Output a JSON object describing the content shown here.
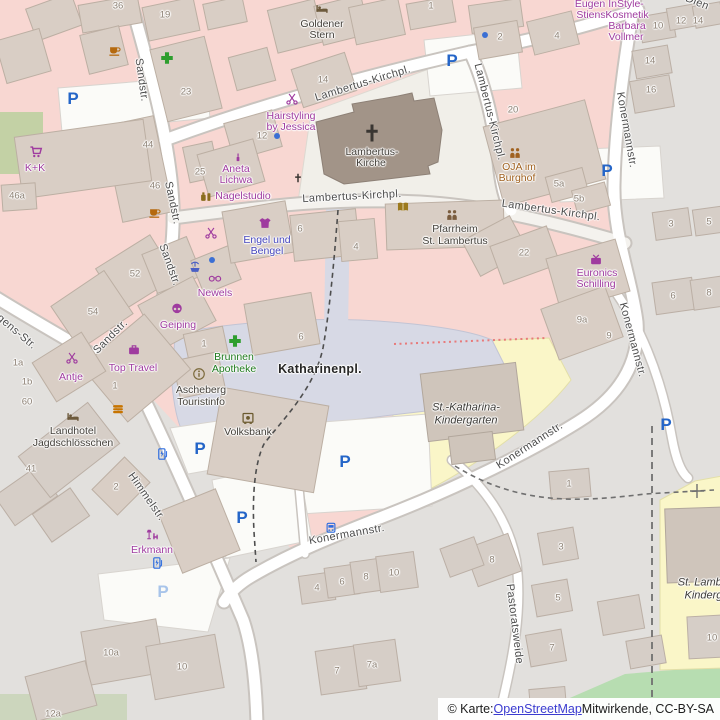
{
  "attribution": {
    "prefix": "© Karte: ",
    "link_text": "OpenStreetMap",
    "suffix": " Mitwirkende, CC-BY-SA"
  },
  "street_labels": [
    {
      "text": "Sandstr.",
      "x": 141,
      "y": 80,
      "rot": 82
    },
    {
      "text": "Sandstr.",
      "x": 172,
      "y": 203,
      "rot": 78
    },
    {
      "text": "Sandstr.",
      "x": 169,
      "y": 265,
      "rot": 70
    },
    {
      "text": "Sandstr.",
      "x": 111,
      "y": 337,
      "rot": -45
    },
    {
      "text": "Jürgens-Str.",
      "x": 10,
      "y": 327,
      "rot": 40
    },
    {
      "text": "Himmelstr.",
      "x": 146,
      "y": 497,
      "rot": 55
    },
    {
      "text": "Lambertus-Kirchpl.",
      "x": 363,
      "y": 84,
      "rot": -17
    },
    {
      "text": "Lambertus-Kirchpl.",
      "x": 489,
      "y": 112,
      "rot": 76
    },
    {
      "text": "Lambertus-Kirchpl.",
      "x": 352,
      "y": 197,
      "rot": -3
    },
    {
      "text": "Lambertus-Kirchpl.",
      "x": 551,
      "y": 211,
      "rot": 8
    },
    {
      "text": "Konermannstr.",
      "x": 626,
      "y": 130,
      "rot": 80
    },
    {
      "text": "Konermannstr.",
      "x": 632,
      "y": 340,
      "rot": 75
    },
    {
      "text": "Konermannstr.",
      "x": 530,
      "y": 446,
      "rot": -33
    },
    {
      "text": "Konermannstr.",
      "x": 347,
      "y": 535,
      "rot": -10
    },
    {
      "text": "Pastoratsweide",
      "x": 514,
      "y": 624,
      "rot": 83
    },
    {
      "text": "Dien",
      "x": 697,
      "y": 3,
      "rot": 22
    }
  ],
  "house_numbers": [
    {
      "text": "36",
      "x": 118,
      "y": 6
    },
    {
      "text": "19",
      "x": 165,
      "y": 15
    },
    {
      "text": "23",
      "x": 186,
      "y": 92
    },
    {
      "text": "25",
      "x": 200,
      "y": 172
    },
    {
      "text": "44",
      "x": 148,
      "y": 145
    },
    {
      "text": "46",
      "x": 155,
      "y": 186
    },
    {
      "text": "46a",
      "x": 17,
      "y": 196
    },
    {
      "text": "52",
      "x": 135,
      "y": 274
    },
    {
      "text": "54",
      "x": 93,
      "y": 312
    },
    {
      "text": "14",
      "x": 323,
      "y": 80
    },
    {
      "text": "12",
      "x": 262,
      "y": 136
    },
    {
      "text": "1",
      "x": 431,
      "y": 6
    },
    {
      "text": "2",
      "x": 500,
      "y": 37
    },
    {
      "text": "4",
      "x": 557,
      "y": 36
    },
    {
      "text": "20",
      "x": 513,
      "y": 110
    },
    {
      "text": "5a",
      "x": 559,
      "y": 184
    },
    {
      "text": "5b",
      "x": 579,
      "y": 199
    },
    {
      "text": "10",
      "x": 658,
      "y": 26
    },
    {
      "text": "12",
      "x": 681,
      "y": 21
    },
    {
      "text": "14",
      "x": 698,
      "y": 21
    },
    {
      "text": "14",
      "x": 650,
      "y": 61
    },
    {
      "text": "16",
      "x": 651,
      "y": 90
    },
    {
      "text": "3",
      "x": 671,
      "y": 224
    },
    {
      "text": "5",
      "x": 709,
      "y": 222
    },
    {
      "text": "22",
      "x": 524,
      "y": 253
    },
    {
      "text": "9a",
      "x": 582,
      "y": 320
    },
    {
      "text": "9",
      "x": 609,
      "y": 336
    },
    {
      "text": "6",
      "x": 673,
      "y": 296
    },
    {
      "text": "8",
      "x": 709,
      "y": 293
    },
    {
      "text": "6",
      "x": 300,
      "y": 229
    },
    {
      "text": "4",
      "x": 356,
      "y": 247
    },
    {
      "text": "6",
      "x": 301,
      "y": 337
    },
    {
      "text": "1",
      "x": 204,
      "y": 344
    },
    {
      "text": "1",
      "x": 115,
      "y": 386
    },
    {
      "text": "1a",
      "x": 18,
      "y": 363
    },
    {
      "text": "1b",
      "x": 27,
      "y": 382
    },
    {
      "text": "60",
      "x": 27,
      "y": 402
    },
    {
      "text": "41",
      "x": 31,
      "y": 469
    },
    {
      "text": "2",
      "x": 116,
      "y": 487
    },
    {
      "text": "4",
      "x": 317,
      "y": 588
    },
    {
      "text": "6",
      "x": 342,
      "y": 582
    },
    {
      "text": "8",
      "x": 366,
      "y": 577
    },
    {
      "text": "10",
      "x": 394,
      "y": 573
    },
    {
      "text": "7",
      "x": 337,
      "y": 671
    },
    {
      "text": "7a",
      "x": 372,
      "y": 665
    },
    {
      "text": "10",
      "x": 712,
      "y": 638
    },
    {
      "text": "1",
      "x": 569,
      "y": 484
    },
    {
      "text": "3",
      "x": 561,
      "y": 547
    },
    {
      "text": "5",
      "x": 558,
      "y": 598
    },
    {
      "text": "7",
      "x": 552,
      "y": 648
    },
    {
      "text": "8",
      "x": 492,
      "y": 560
    },
    {
      "text": "10a",
      "x": 111,
      "y": 653
    },
    {
      "text": "10",
      "x": 182,
      "y": 667
    },
    {
      "text": "12a",
      "x": 53,
      "y": 714
    }
  ],
  "poi_labels": [
    {
      "text": "Goldener",
      "x": 322,
      "y": 24,
      "cls": "drk"
    },
    {
      "text": "Stern",
      "x": 322,
      "y": 35,
      "cls": "drk"
    },
    {
      "text": "Hairstyling",
      "x": 291,
      "y": 116,
      "cls": "shop"
    },
    {
      "text": "by Jessica",
      "x": 291,
      "y": 127,
      "cls": "shop"
    },
    {
      "text": "Aneta",
      "x": 236,
      "y": 169,
      "cls": "shop"
    },
    {
      "text": "Lichwa",
      "x": 236,
      "y": 180,
      "cls": "shop"
    },
    {
      "text": "Nagelstudio",
      "x": 243,
      "y": 196,
      "cls": "shop"
    },
    {
      "text": "K+K",
      "x": 35,
      "y": 168,
      "cls": "shop"
    },
    {
      "text": "Engel und",
      "x": 267,
      "y": 240,
      "cls": "blu"
    },
    {
      "text": "Bengel",
      "x": 267,
      "y": 251,
      "cls": "blu"
    },
    {
      "text": "Newels",
      "x": 215,
      "y": 293,
      "cls": "shop"
    },
    {
      "text": "Geiping",
      "x": 178,
      "y": 325,
      "cls": "shop"
    },
    {
      "text": "Top Travel",
      "x": 133,
      "y": 368,
      "cls": "shop"
    },
    {
      "text": "Antje",
      "x": 71,
      "y": 377,
      "cls": "shop"
    },
    {
      "text": "Brunnen",
      "x": 234,
      "y": 357,
      "cls": "grn"
    },
    {
      "text": "Apotheke",
      "x": 234,
      "y": 369,
      "cls": "grn"
    },
    {
      "text": "Ascheberg",
      "x": 201,
      "y": 390,
      "cls": "drk"
    },
    {
      "text": "Touristinfo",
      "x": 201,
      "y": 402,
      "cls": "drk"
    },
    {
      "text": "Volksbank",
      "x": 248,
      "y": 432,
      "cls": "drk"
    },
    {
      "text": "Landhotel",
      "x": 73,
      "y": 431,
      "cls": "drk"
    },
    {
      "text": "Jagdschlösschen",
      "x": 73,
      "y": 443,
      "cls": "drk"
    },
    {
      "text": "Erkmann",
      "x": 152,
      "y": 550,
      "cls": "shop"
    },
    {
      "text": "Pfarrheim",
      "x": 455,
      "y": 229,
      "cls": "drk"
    },
    {
      "text": "St. Lambertus",
      "x": 455,
      "y": 241,
      "cls": "drk"
    },
    {
      "text": "OJA im",
      "x": 519,
      "y": 167,
      "cls": "amb"
    },
    {
      "text": "Burghof",
      "x": 517,
      "y": 178,
      "cls": "amb"
    },
    {
      "text": "Eugen",
      "x": 590,
      "y": 4,
      "cls": "shop"
    },
    {
      "text": "Stiens",
      "x": 591,
      "y": 15,
      "cls": "shop"
    },
    {
      "text": "InStyle-",
      "x": 626,
      "y": 4,
      "cls": "shop"
    },
    {
      "text": "Kosmetik",
      "x": 627,
      "y": 15,
      "cls": "shop"
    },
    {
      "text": "Barbara",
      "x": 627,
      "y": 26,
      "cls": "shop"
    },
    {
      "text": "Vollmer",
      "x": 626,
      "y": 37,
      "cls": "shop"
    },
    {
      "text": "Euronics",
      "x": 597,
      "y": 273,
      "cls": "shop"
    },
    {
      "text": "Schilling",
      "x": 596,
      "y": 284,
      "cls": "shop"
    },
    {
      "text": "Lambertus-",
      "x": 372,
      "y": 152,
      "cls": "drk"
    },
    {
      "text": "Kirche",
      "x": 371,
      "y": 163,
      "cls": "drk"
    },
    {
      "text": "St.-Katharina-",
      "x": 466,
      "y": 408,
      "cls": "ital"
    },
    {
      "text": "Kindergarten",
      "x": 466,
      "y": 421,
      "cls": "ital"
    },
    {
      "text": "St. Lambertus",
      "x": 712,
      "y": 583,
      "cls": "ital"
    },
    {
      "text": "Kindergarten",
      "x": 716,
      "y": 596,
      "cls": "ital"
    },
    {
      "text": "Katharinenpl.",
      "x": 320,
      "y": 369,
      "cls": "place"
    }
  ],
  "icons": [
    {
      "icon": "supermarket",
      "x": 36,
      "y": 152,
      "color": "#9f3b9f"
    },
    {
      "icon": "cafe",
      "x": 115,
      "y": 50,
      "color": "#b5690e"
    },
    {
      "icon": "cafe",
      "x": 155,
      "y": 212,
      "color": "#b5690e"
    },
    {
      "icon": "pharmacy",
      "x": 167,
      "y": 58,
      "color": "#2e9e2e",
      "size": 15
    },
    {
      "icon": "pharmacy",
      "x": 235,
      "y": 341,
      "color": "#2e9e2e",
      "size": 15
    },
    {
      "icon": "hairdresser",
      "x": 292,
      "y": 99,
      "color": "#9f3b9f"
    },
    {
      "icon": "hairdresser",
      "x": 72,
      "y": 358,
      "color": "#9f3b9f"
    },
    {
      "icon": "hairdresser",
      "x": 211,
      "y": 233,
      "color": "#9f3b9f"
    },
    {
      "icon": "beauty",
      "x": 238,
      "y": 157,
      "color": "#9f3b9f",
      "size": 11
    },
    {
      "icon": "cosmetics",
      "x": 206,
      "y": 196,
      "color": "#8a6d1e"
    },
    {
      "icon": "clothes",
      "x": 265,
      "y": 223,
      "color": "#9f3b9f"
    },
    {
      "icon": "optician",
      "x": 215,
      "y": 278,
      "color": "#9f3b9f"
    },
    {
      "icon": "fountain",
      "x": 195,
      "y": 267,
      "color": "#4a5fc4"
    },
    {
      "icon": "bakery",
      "x": 177,
      "y": 308,
      "color": "#9f3b9f"
    },
    {
      "icon": "travel",
      "x": 134,
      "y": 350,
      "color": "#9f3b9f"
    },
    {
      "icon": "fastfood",
      "x": 118,
      "y": 409,
      "color": "#c77400"
    },
    {
      "icon": "hotel",
      "x": 322,
      "y": 9,
      "color": "#6d5a3c"
    },
    {
      "icon": "hotel",
      "x": 73,
      "y": 417,
      "color": "#6d5a3c"
    },
    {
      "icon": "info",
      "x": 199,
      "y": 374,
      "color": "#7c6a3c"
    },
    {
      "icon": "bank",
      "x": 248,
      "y": 418,
      "color": "#6b5a2e"
    },
    {
      "icon": "book",
      "x": 403,
      "y": 207,
      "color": "#9c7a1e"
    },
    {
      "icon": "community",
      "x": 452,
      "y": 215,
      "color": "#7a5c3e"
    },
    {
      "icon": "community",
      "x": 515,
      "y": 153,
      "color": "#a0611f"
    },
    {
      "icon": "electronics",
      "x": 596,
      "y": 260,
      "color": "#9f3b9f"
    },
    {
      "icon": "furniture",
      "x": 152,
      "y": 535,
      "color": "#9f3b9f"
    },
    {
      "icon": "church",
      "x": 372,
      "y": 133,
      "color": "#3a3632",
      "size": 20
    },
    {
      "icon": "church",
      "x": 298,
      "y": 178,
      "color": "#3a3632",
      "size": 10
    },
    {
      "icon": "bus",
      "x": 331,
      "y": 528,
      "color": "#2b6bdf",
      "size": 13
    },
    {
      "icon": "charging",
      "x": 163,
      "y": 454,
      "color": "#2b6bdf",
      "size": 13
    },
    {
      "icon": "charging",
      "x": 158,
      "y": 563,
      "color": "#2b6bdf",
      "size": 13
    },
    {
      "icon": "dot",
      "x": 277,
      "y": 136,
      "color": "#3b6fd4",
      "size": 7
    },
    {
      "icon": "dot",
      "x": 212,
      "y": 260,
      "color": "#3b6fd4",
      "size": 7
    },
    {
      "icon": "dot",
      "x": 485,
      "y": 35,
      "color": "#3b6fd4",
      "size": 7
    }
  ],
  "parking": [
    {
      "text": "P",
      "x": 73,
      "y": 99
    },
    {
      "text": "P",
      "x": 452,
      "y": 61
    },
    {
      "text": "P",
      "x": 607,
      "y": 171
    },
    {
      "text": "P",
      "x": 345,
      "y": 462
    },
    {
      "text": "P",
      "x": 200,
      "y": 449
    },
    {
      "text": "P",
      "x": 242,
      "y": 518
    },
    {
      "text": "P",
      "x": 666,
      "y": 425
    },
    {
      "text": "P",
      "x": 163,
      "y": 592,
      "cls": "faded"
    }
  ],
  "colors": {
    "pink_area": "#f8d7d2",
    "gray_area": "#e2e0dd",
    "yellow_area": "#faf6c8",
    "green_area": "#b7ddb1",
    "plaza": "#d7d9e5",
    "road": "#ffffff",
    "church": "#a29488",
    "shop_label": "#9f3b9f",
    "pharmacy_green": "#2e9e2e",
    "parking_blue": "#2465c8",
    "link_blue": "#3b3bd0"
  }
}
